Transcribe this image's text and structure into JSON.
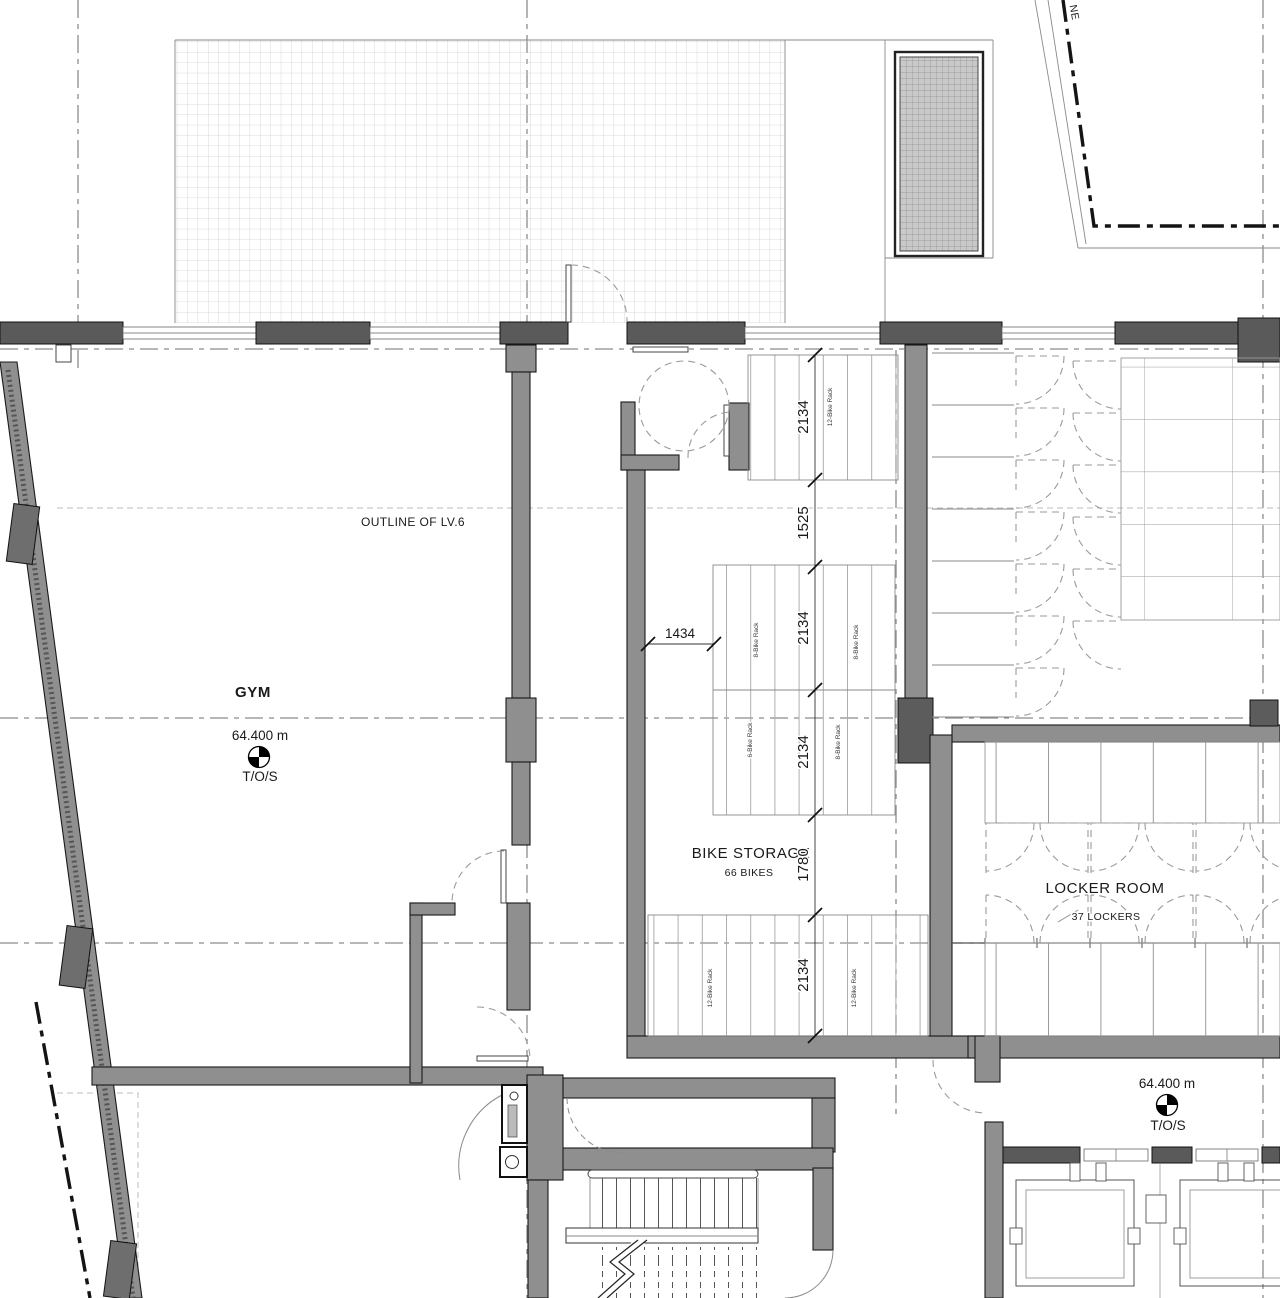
{
  "plan": {
    "site": {
      "street_label": "NE"
    },
    "gym": {
      "name": "GYM",
      "outline_label": "OUTLINE OF LV.6",
      "level": "64.400 m",
      "level_ref": "T/O/S"
    },
    "bike_storage": {
      "name": "BIKE STORAGE",
      "capacity": "66 BIKES",
      "rack_labels": {
        "top": "12-Bike Rack",
        "mid_nw": "8-Bike Rack",
        "mid_ne": "8-Bike Rack",
        "mid_sw": "6-Bike Rack",
        "mid_se": "8-Bike Rack",
        "bot_w": "12-Bike Rack",
        "bot_e": "12-Bike Rack"
      },
      "dims": {
        "width": "1434",
        "col": [
          "2134",
          "1525",
          "2134",
          "2134",
          "1780",
          "2134"
        ]
      }
    },
    "locker_room": {
      "name": "LOCKER ROOM",
      "capacity": "37 LOCKERS"
    },
    "elevator_lobby": {
      "level": "64.400 m",
      "level_ref": "T/O/S"
    },
    "colors": {
      "wall_fill": "#8f8f8f",
      "wall_dark": "#5a5a5a",
      "line": "#1a1a1a"
    }
  }
}
